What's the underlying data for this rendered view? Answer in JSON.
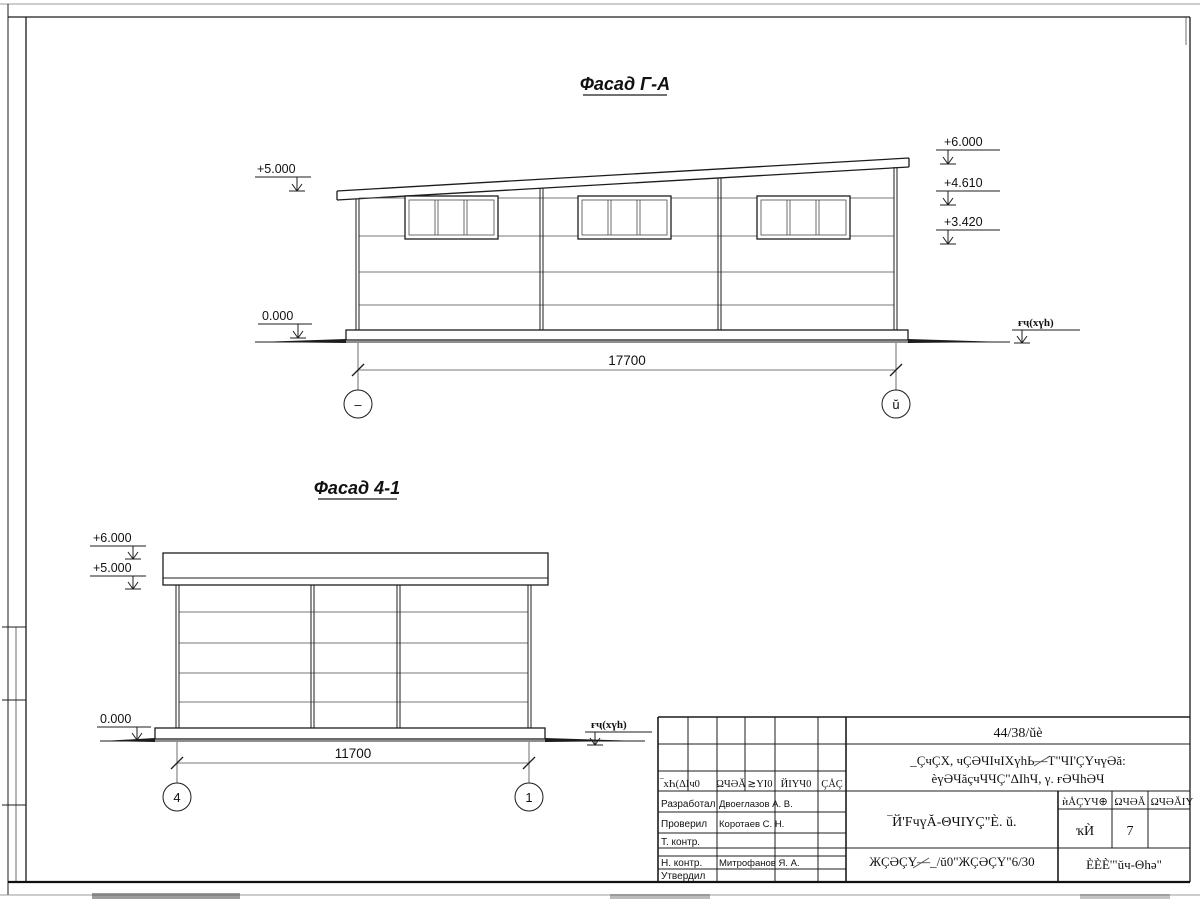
{
  "titles": {
    "facade1": "Фасад Г-А",
    "facade2": "Фасад 4-1"
  },
  "facade1": {
    "dim": "17700",
    "axis_left": "–",
    "axis_right": "ŭ",
    "elev_plus5": "+5.000",
    "elev_zero": "0.000",
    "elev_plus6": "+6.000",
    "elev_p461": "+4.610",
    "elev_p342": "+3.420",
    "ground": "ғҷ(хүһ)"
  },
  "facade2": {
    "dim": "11700",
    "axis_left": "4",
    "axis_right": "1",
    "elev_plus6": "+6.000",
    "elev_plus5": "+5.000",
    "elev_zero": "0.000",
    "ground": "ғҷ(хүһ)"
  },
  "stamp": {
    "doc_number": "44/38/ŭè",
    "project_line1": "_ÇчÇХ, чÇӘЧIчIХүһЬ—Т\"ЧI'ÇҮчүӘă:",
    "project_line2": "ѐүӘЧăçчЧЧÇ\"ΔIһЧ, γ. ғӘЧһӘЧ",
    "rev_cols": {
      "c1": "‾хҺ(ΔIч0",
      "c2": "ΩЧӘĂ",
      "c3": "≳ΥI0",
      "c4": "ЙIΥЧ0",
      "c5": "ÇÅÇ"
    },
    "roles": {
      "developed": "Разработал",
      "checked": "Проверил",
      "tcontrol": "Т. контр.",
      "ncontrol": "Н. контр.",
      "approved": "Утвердил"
    },
    "names": {
      "developed": "Двоеглазов А. В.",
      "checked": "Коротаев С. Н.",
      "ncontrol": "Митрофанов Я. А."
    },
    "title_main": "‾Й'FчүĂ-ΘЧIΥÇ\"È. ŭ.",
    "title_code": "ЖÇӘÇҮ—_/ŭ0\"ЖÇӘÇҮ\"6/30",
    "grid": {
      "stage_h": "ѝÅÇҮЧ⊕",
      "sheet_h": "ΩЧӘĂ",
      "sheets_h": "ΩЧӘĂIY",
      "stage_v": "ҡЍ",
      "sheet_v": "7"
    },
    "company": "ÈÈÈ'\"ŭч-Θһә\""
  }
}
